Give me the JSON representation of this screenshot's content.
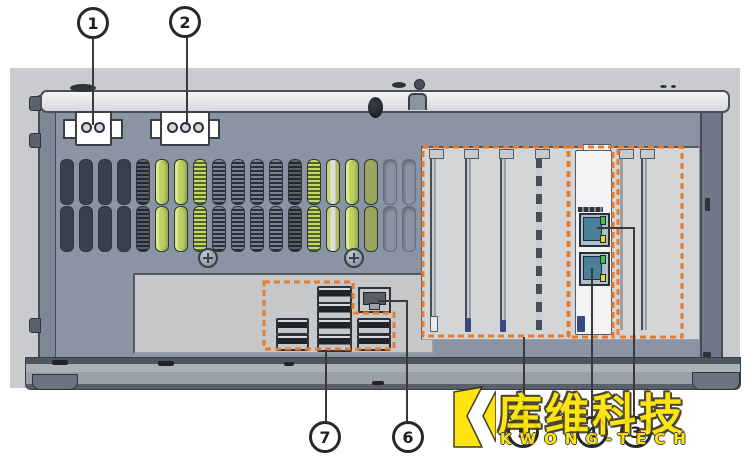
{
  "diagram": {
    "type": "hardware-rear-panel-callout-diagram",
    "callouts": [
      {
        "number": "1"
      },
      {
        "number": "2"
      },
      {
        "number": "3"
      },
      {
        "number": "4"
      },
      {
        "number": "5"
      },
      {
        "number": "6"
      },
      {
        "number": "7"
      }
    ],
    "vent_pattern": [
      "dark",
      "dark",
      "dark",
      "dark",
      "hatch",
      "green",
      "green",
      "greenhatch",
      "coil",
      "coil",
      "coil",
      "coil",
      "hatch",
      "greenhatch",
      "greenwhite",
      "green",
      "olive",
      "outline",
      "outline"
    ],
    "colors": {
      "outline_orange": "#E87A2C",
      "vent_highlight_green": "#C3D869",
      "chassis_face": "#8A94A3",
      "backdrop_gray": "#C9CBCE"
    }
  },
  "watermark": {
    "cn_text": "库维科技",
    "en_text": "KWONG-TECH",
    "color": "#FFE200"
  }
}
